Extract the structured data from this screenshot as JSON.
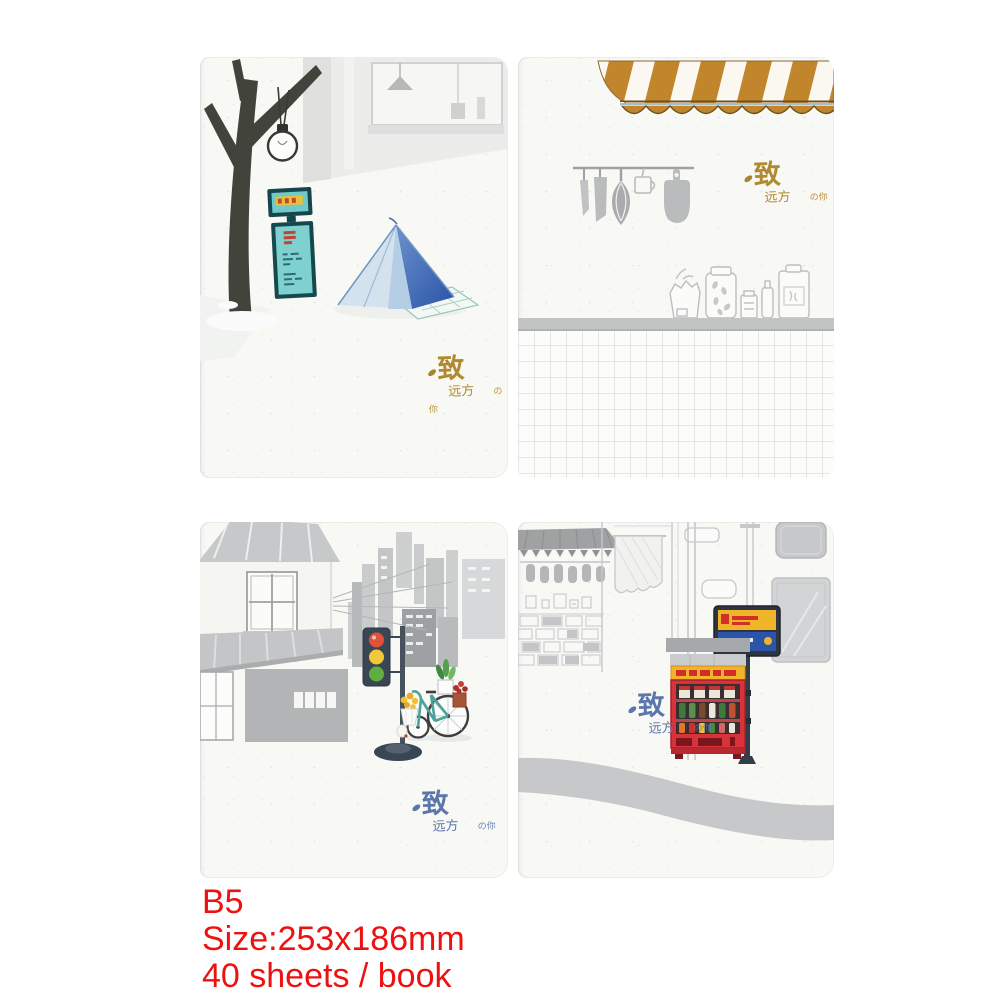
{
  "product": {
    "size_class": "B5",
    "dimensions": "Size:253x186mm",
    "sheet_count": "40 sheets / book"
  },
  "logo": {
    "main": "致",
    "sub": "远方",
    "small": "の你"
  },
  "notebooks": [
    {
      "alt": "Winter street cover: dark tree, hanging bulb lamp, teal sign board, blue tent, gold logo"
    },
    {
      "alt": "Kitchen cover: gold striped awning, grey hanging utensils, sketched jars on a shelf, tiled wall, gold logo"
    },
    {
      "alt": "Street corner cover: grey house and skyline, traffic light, bicycle with flowers, blue logo"
    },
    {
      "alt": "Old street cover: sketched shops, street sign, red vending machine, grey road, blue logo"
    }
  ],
  "colors": {
    "caption_red": "#ee1111",
    "paper": "#f8f8f5",
    "sketch_grey": "#c6c8ca",
    "logo_gold": "#b08a2e",
    "logo_blue": "#5b76ab",
    "awning_gold": "#c1862b",
    "tent_blue": "#3a68b8",
    "sign_teal": "#7ed1cf",
    "vending_red": "#d8323a",
    "sign_yellow": "#f0b429",
    "sign_panel_blue": "#2a55a8"
  }
}
